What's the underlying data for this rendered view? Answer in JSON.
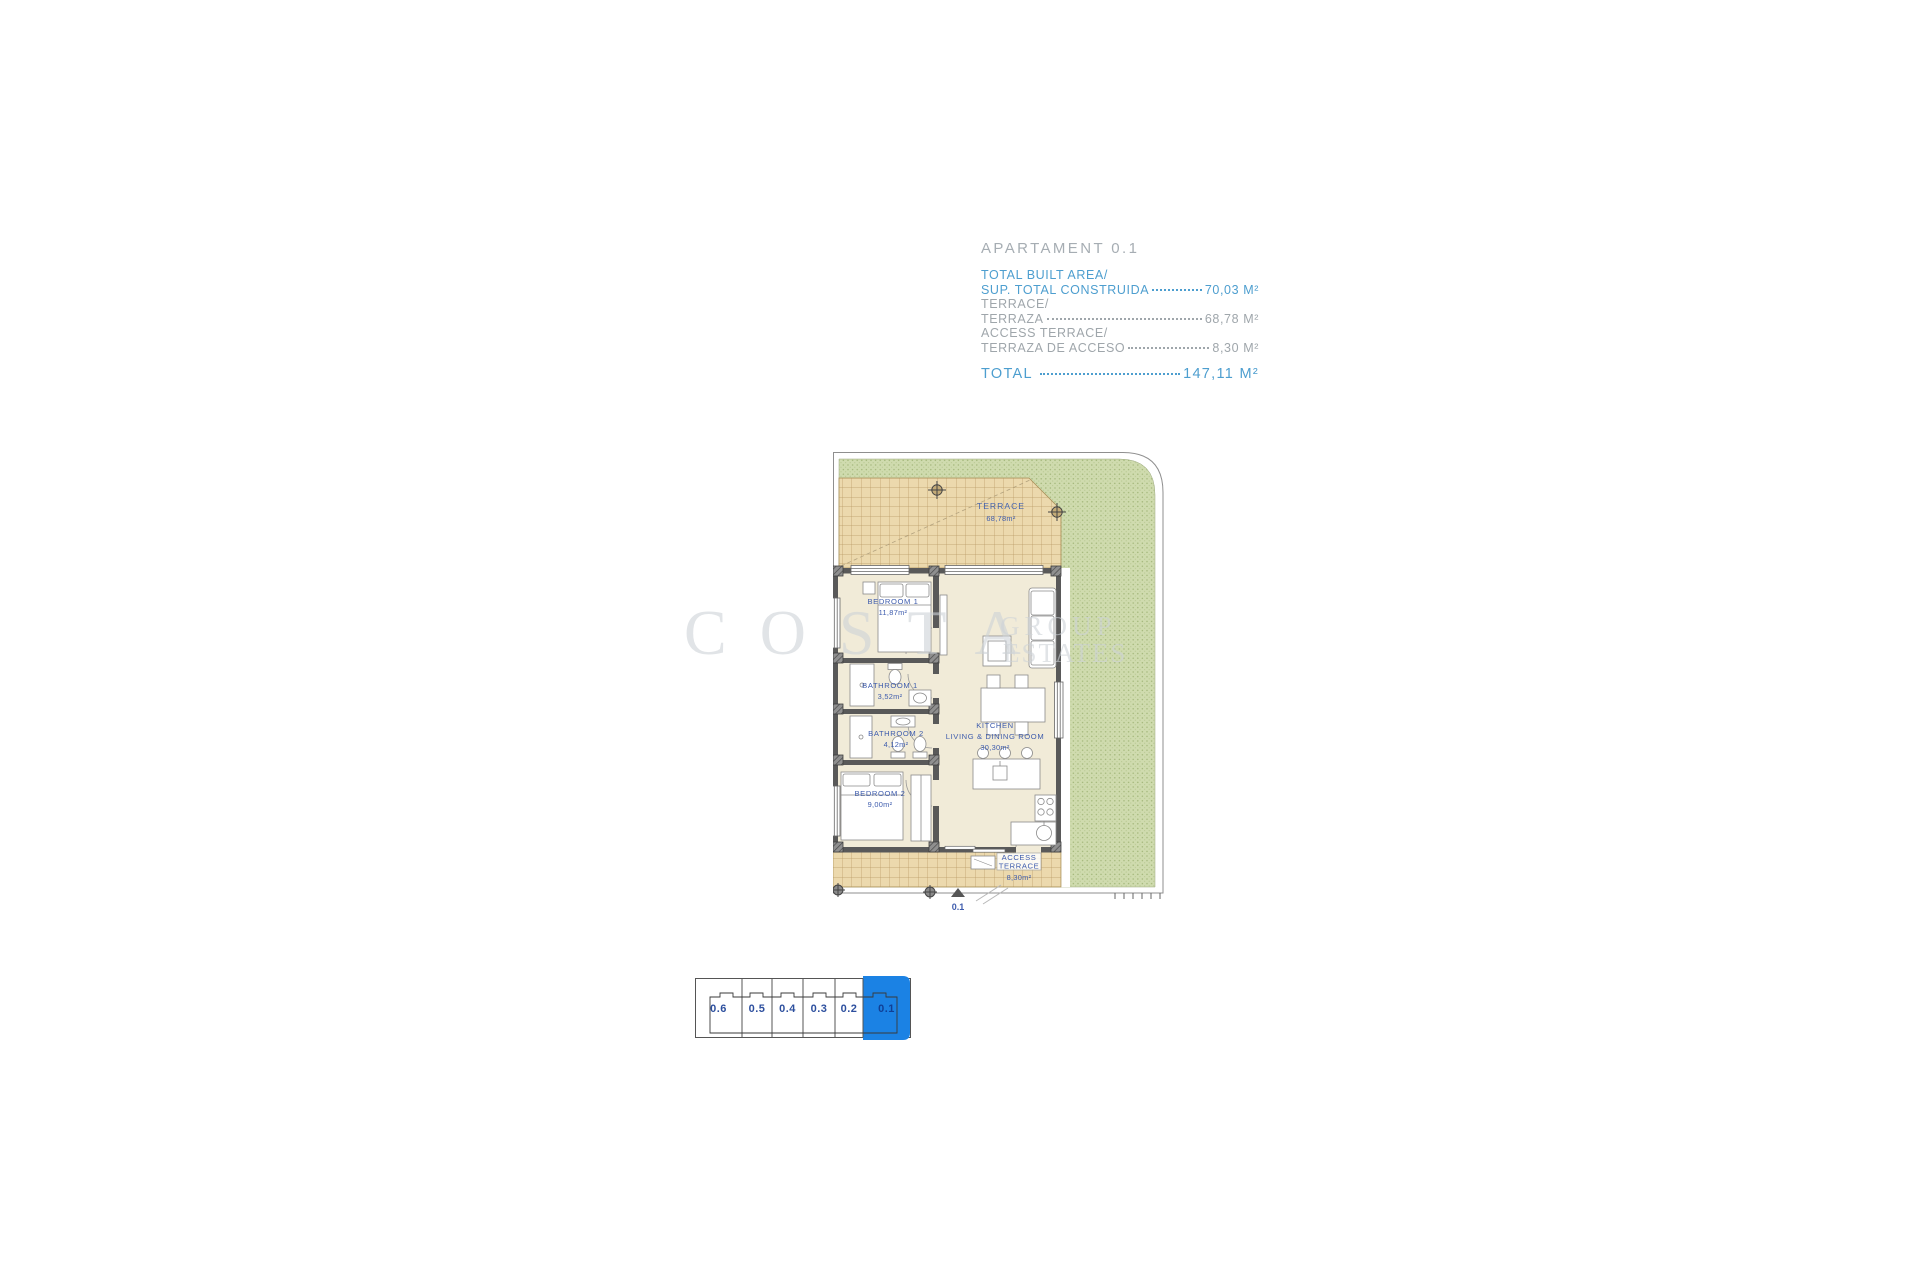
{
  "info": {
    "title": "APARTAMENT 0.1",
    "rows": [
      {
        "line1": "TOTAL BUILT AREA/",
        "line2": "SUP. TOTAL CONSTRUIDA",
        "value": "70,03 M²"
      },
      {
        "line1": "TERRACE/",
        "line2": "TERRAZA",
        "value": "68,78 M²"
      },
      {
        "line1": "ACCESS TERRACE/",
        "line2": "TERRAZA DE ACCESO",
        "value": "8,30 M²"
      }
    ],
    "total_label": "TOTAL",
    "total_value": "147,11 M²"
  },
  "floorplan": {
    "terrace": {
      "name": "TERRACE",
      "area": "68,78m²"
    },
    "bedroom1": {
      "name": "BEDROOM 1",
      "area": "11,87m²"
    },
    "bathroom1": {
      "name": "BATHROOM 1",
      "area": "3,52m²"
    },
    "bathroom2": {
      "name": "BATHROOM 2",
      "area": "4,12m²"
    },
    "bedroom2": {
      "name": "BEDROOM 2",
      "area": "9,00m²"
    },
    "kitchen": {
      "name": "KITCHEN",
      "name2": "LIVING & DINING ROOM",
      "area": "30,30m²"
    },
    "access_terrace": {
      "name": "ACCESS",
      "name2": "TERRACE",
      "area": "8,30m²"
    },
    "entrance_marker": "0.1"
  },
  "keyplan": {
    "units": [
      "0.6",
      "0.5",
      "0.4",
      "0.3",
      "0.2",
      "0.1"
    ],
    "highlighted_unit": "0.1",
    "highlight_color": "#1b82e4"
  },
  "watermark": {
    "word1": "COSTA",
    "word2": "GROUP",
    "word3": "ESTATES"
  },
  "colors": {
    "accent_blue": "#4d9ecf",
    "muted_gray": "#9fa6ab",
    "plan_label_blue": "#3e5cad",
    "garden_green": "#cfdbae",
    "terrace_tan": "#ecd9ad",
    "wall_gray": "#595959"
  }
}
